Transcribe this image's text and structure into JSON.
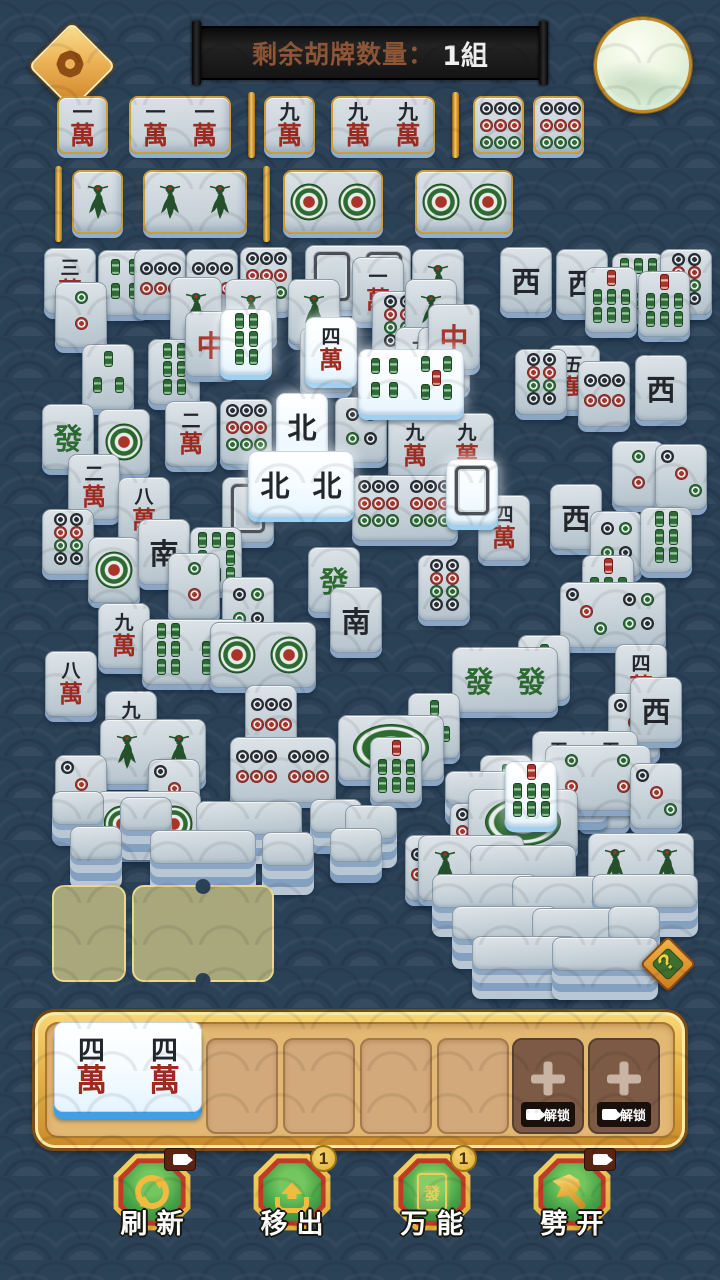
{
  "header": {
    "banner_label": "剩余胡牌数量：",
    "banner_value": "1組",
    "settings_icon": "gear-icon",
    "moon_decoration": "moon"
  },
  "help": {
    "label": "?"
  },
  "colors": {
    "background": "#2b4156",
    "gold": "#e8b83c",
    "tile_body": "#c6d1d8",
    "tile_highlight": "#ffffff",
    "tile_rim": "#8ba6c5",
    "tile_rim_highlight": "#9ed0f2",
    "face_red": "#9e2b22",
    "face_green": "#2d6b33",
    "face_black": "#23272b"
  },
  "legend": {
    "w": "characters tile: number over 萬",
    "d": "dots tile (number of circles)",
    "b": "bamboo tile (number of sticks, b1 is the bird)",
    "back": "face-down tile",
    "edge": "stacked tile edge, no face visible",
    "wan_nums": [
      "一",
      "二",
      "三",
      "四",
      "五",
      "六",
      "七",
      "八",
      "九"
    ],
    "wan_char": "萬",
    "honors": {
      "C": "中",
      "F": "發",
      "N": "北",
      "S": "南",
      "W": "西"
    }
  },
  "collection": {
    "row1": [
      {
        "kind": "tile",
        "x": 57,
        "y": 96,
        "w": 51,
        "h": 58,
        "f": [
          "w1"
        ]
      },
      {
        "kind": "tile",
        "x": 129,
        "y": 96,
        "w": 102,
        "h": 58,
        "f": [
          "w1",
          "w1"
        ]
      },
      {
        "kind": "sep",
        "x": 248,
        "y": 92,
        "h": 66
      },
      {
        "kind": "tile",
        "x": 264,
        "y": 96,
        "w": 51,
        "h": 58,
        "f": [
          "w9"
        ]
      },
      {
        "kind": "tile",
        "x": 331,
        "y": 96,
        "w": 104,
        "h": 58,
        "f": [
          "w9",
          "w9"
        ]
      },
      {
        "kind": "sep",
        "x": 452,
        "y": 92,
        "h": 66
      },
      {
        "kind": "tile",
        "x": 473,
        "y": 96,
        "w": 51,
        "h": 58,
        "f": [
          "d9"
        ]
      },
      {
        "kind": "tile",
        "x": 533,
        "y": 96,
        "w": 51,
        "h": 58,
        "f": [
          "d9"
        ]
      }
    ],
    "row2": [
      {
        "kind": "sep",
        "x": 55,
        "y": 166,
        "h": 76
      },
      {
        "kind": "tile",
        "x": 72,
        "y": 170,
        "w": 51,
        "h": 64,
        "f": [
          "b1"
        ]
      },
      {
        "kind": "tile",
        "x": 143,
        "y": 170,
        "w": 104,
        "h": 64,
        "f": [
          "b1",
          "b1"
        ]
      },
      {
        "kind": "sep",
        "x": 263,
        "y": 166,
        "h": 76
      },
      {
        "kind": "tile",
        "x": 283,
        "y": 170,
        "w": 100,
        "h": 64,
        "f": [
          "d1",
          "d1"
        ]
      },
      {
        "kind": "tile",
        "x": 415,
        "y": 170,
        "w": 98,
        "h": 64,
        "f": [
          "d1",
          "d1"
        ]
      }
    ]
  },
  "pile": [
    {
      "x": 44,
      "y": 248,
      "f": [
        "w3"
      ]
    },
    {
      "x": 98,
      "y": 250,
      "f": [
        "b4"
      ]
    },
    {
      "x": 134,
      "y": 249,
      "f": [
        "d6"
      ]
    },
    {
      "x": 186,
      "y": 249,
      "f": [
        "d6"
      ]
    },
    {
      "x": 240,
      "y": 247,
      "f": [
        "d9"
      ]
    },
    {
      "x": 305,
      "y": 245,
      "w": 106,
      "f": [
        "back",
        "back"
      ]
    },
    {
      "x": 352,
      "y": 257,
      "f": [
        "w1"
      ]
    },
    {
      "x": 412,
      "y": 249,
      "f": [
        "b1"
      ]
    },
    {
      "x": 500,
      "y": 247,
      "f": [
        "W"
      ]
    },
    {
      "x": 556,
      "y": 249,
      "f": [
        "W"
      ]
    },
    {
      "x": 612,
      "y": 253,
      "f": [
        "b8"
      ]
    },
    {
      "x": 660,
      "y": 249,
      "f": [
        "d8"
      ]
    },
    {
      "x": 55,
      "y": 282,
      "f": [
        "d2"
      ]
    },
    {
      "x": 170,
      "y": 277,
      "f": [
        "b1"
      ]
    },
    {
      "x": 225,
      "y": 279,
      "f": [
        "b1"
      ]
    },
    {
      "x": 288,
      "y": 279,
      "f": [
        "b1"
      ]
    },
    {
      "x": 372,
      "y": 291,
      "f": [
        "d8"
      ]
    },
    {
      "x": 405,
      "y": 279,
      "f": [
        "b1"
      ]
    },
    {
      "x": 585,
      "y": 267,
      "f": [
        "b7"
      ]
    },
    {
      "x": 638,
      "y": 271,
      "f": [
        "b7"
      ]
    },
    {
      "x": 82,
      "y": 344,
      "f": [
        "b3"
      ]
    },
    {
      "x": 148,
      "y": 339,
      "f": [
        "b6"
      ]
    },
    {
      "x": 185,
      "y": 311,
      "f": [
        "C"
      ]
    },
    {
      "x": 300,
      "y": 327,
      "f": [
        "w2"
      ]
    },
    {
      "x": 395,
      "y": 327,
      "f": [
        "w9"
      ]
    },
    {
      "x": 418,
      "y": 327,
      "f": [
        "w2"
      ]
    },
    {
      "x": 428,
      "y": 304,
      "f": [
        "C"
      ]
    },
    {
      "x": 548,
      "y": 345,
      "f": [
        "w5"
      ]
    },
    {
      "x": 578,
      "y": 361,
      "f": [
        "d6"
      ]
    },
    {
      "x": 635,
      "y": 355,
      "f": [
        "W"
      ]
    },
    {
      "x": 42,
      "y": 404,
      "f": [
        "F"
      ]
    },
    {
      "x": 98,
      "y": 409,
      "f": [
        "d1"
      ]
    },
    {
      "x": 165,
      "y": 401,
      "f": [
        "w2"
      ]
    },
    {
      "x": 220,
      "y": 399,
      "f": [
        "d9"
      ]
    },
    {
      "x": 335,
      "y": 397,
      "f": [
        "d4"
      ]
    },
    {
      "x": 515,
      "y": 349,
      "f": [
        "d8"
      ]
    },
    {
      "x": 388,
      "y": 413,
      "w": 106,
      "f": [
        "w9",
        "w9"
      ]
    },
    {
      "x": 612,
      "y": 441,
      "f": [
        "d2"
      ]
    },
    {
      "x": 655,
      "y": 444,
      "f": [
        "d3"
      ]
    },
    {
      "x": 68,
      "y": 454,
      "f": [
        "w2"
      ]
    },
    {
      "x": 118,
      "y": 477,
      "f": [
        "w8"
      ]
    },
    {
      "x": 42,
      "y": 509,
      "f": [
        "d8"
      ]
    },
    {
      "x": 222,
      "y": 477,
      "f": [
        "back"
      ]
    },
    {
      "x": 352,
      "y": 475,
      "w": 106,
      "f": [
        "d9",
        "d9"
      ]
    },
    {
      "x": 478,
      "y": 495,
      "f": [
        "w4"
      ]
    },
    {
      "x": 550,
      "y": 484,
      "f": [
        "W"
      ]
    },
    {
      "x": 590,
      "y": 511,
      "f": [
        "d4"
      ]
    },
    {
      "x": 640,
      "y": 507,
      "f": [
        "b6"
      ]
    },
    {
      "x": 88,
      "y": 537,
      "f": [
        "d1"
      ]
    },
    {
      "x": 138,
      "y": 519,
      "f": [
        "S"
      ]
    },
    {
      "x": 190,
      "y": 527,
      "f": [
        "b8"
      ]
    },
    {
      "x": 308,
      "y": 547,
      "f": [
        "F"
      ]
    },
    {
      "x": 418,
      "y": 555,
      "f": [
        "d8"
      ]
    },
    {
      "x": 582,
      "y": 555,
      "f": [
        "b7"
      ]
    },
    {
      "x": 168,
      "y": 553,
      "f": [
        "d2"
      ]
    },
    {
      "x": 222,
      "y": 577,
      "f": [
        "d4"
      ]
    },
    {
      "x": 98,
      "y": 603,
      "f": [
        "w9"
      ]
    },
    {
      "x": 330,
      "y": 587,
      "f": [
        "S"
      ]
    },
    {
      "x": 560,
      "y": 582,
      "w": 106,
      "f": [
        "d3",
        "d4"
      ]
    },
    {
      "x": 142,
      "y": 619,
      "w": 106,
      "f": [
        "b6",
        "b7"
      ]
    },
    {
      "x": 210,
      "y": 622,
      "w": 106,
      "f": [
        "d1",
        "d1"
      ]
    },
    {
      "x": 518,
      "y": 635,
      "f": [
        "b2"
      ]
    },
    {
      "x": 615,
      "y": 644,
      "f": [
        "w4"
      ]
    },
    {
      "x": 452,
      "y": 647,
      "w": 106,
      "f": [
        "F",
        "F"
      ]
    },
    {
      "x": 45,
      "y": 651,
      "f": [
        "w8"
      ]
    },
    {
      "x": 245,
      "y": 685,
      "f": [
        "d6"
      ]
    },
    {
      "x": 408,
      "y": 693,
      "f": [
        "b3"
      ]
    },
    {
      "x": 608,
      "y": 693,
      "f": [
        "d3"
      ]
    },
    {
      "x": 630,
      "y": 677,
      "f": [
        "W"
      ]
    },
    {
      "x": 105,
      "y": 691,
      "f": [
        "w9"
      ]
    },
    {
      "x": 338,
      "y": 715,
      "w": 106,
      "f": [
        "d1w"
      ]
    },
    {
      "x": 100,
      "y": 719,
      "w": 106,
      "f": [
        "b1",
        "b1"
      ]
    },
    {
      "x": 532,
      "y": 731,
      "w": 106,
      "f": [
        "w5",
        "w5"
      ]
    },
    {
      "x": 230,
      "y": 737,
      "w": 106,
      "f": [
        "d6",
        "d6"
      ]
    },
    {
      "x": 370,
      "y": 737,
      "f": [
        "b7"
      ]
    },
    {
      "x": 55,
      "y": 755,
      "f": [
        "d3"
      ]
    },
    {
      "x": 148,
      "y": 759,
      "f": [
        "d3"
      ]
    },
    {
      "x": 480,
      "y": 755,
      "f": [
        "b2"
      ]
    },
    {
      "x": 578,
      "y": 763,
      "f": [
        "d4"
      ]
    },
    {
      "x": 95,
      "y": 791,
      "w": 106,
      "f": [
        "d1",
        "d1"
      ]
    },
    {
      "x": 405,
      "y": 835,
      "f": [
        "d6"
      ]
    },
    {
      "x": 482,
      "y": 814,
      "f": [
        "d2"
      ]
    },
    {
      "x": 445,
      "y": 771,
      "w": 106,
      "f": [
        "edge"
      ],
      "st": 2
    },
    {
      "x": 556,
      "y": 775,
      "f": [
        "edge"
      ],
      "st": 2
    },
    {
      "x": 52,
      "y": 791,
      "f": [
        "edge"
      ],
      "st": 2
    },
    {
      "x": 120,
      "y": 797,
      "f": [
        "edge"
      ],
      "st": 3
    },
    {
      "x": 196,
      "y": 801,
      "w": 106,
      "f": [
        "edge"
      ],
      "st": 3
    },
    {
      "x": 310,
      "y": 799,
      "f": [
        "edge"
      ],
      "st": 2
    },
    {
      "x": 345,
      "y": 805,
      "f": [
        "edge"
      ],
      "st": 3
    },
    {
      "x": 70,
      "y": 826,
      "f": [
        "edge"
      ],
      "st": 3
    },
    {
      "x": 150,
      "y": 830,
      "w": 106,
      "f": [
        "edge"
      ],
      "st": 3
    },
    {
      "x": 262,
      "y": 832,
      "f": [
        "edge"
      ],
      "st": 3
    },
    {
      "x": 330,
      "y": 828,
      "f": [
        "edge"
      ],
      "st": 2
    }
  ],
  "side_pile": [
    {
      "x": 545,
      "y": 745,
      "w": 106,
      "f": [
        "d2",
        "d2"
      ]
    },
    {
      "x": 630,
      "y": 763,
      "f": [
        "d3"
      ]
    },
    {
      "x": 450,
      "y": 803,
      "f": [
        "d9"
      ]
    },
    {
      "x": 468,
      "y": 789,
      "w": 110,
      "f": [
        "d1w"
      ]
    },
    {
      "x": 418,
      "y": 835,
      "w": 106,
      "f": [
        "b1",
        "b1"
      ]
    },
    {
      "x": 588,
      "y": 833,
      "w": 106,
      "f": [
        "b1",
        "b1"
      ]
    },
    {
      "x": 470,
      "y": 845,
      "w": 106,
      "f": [
        "edge"
      ],
      "st": 2
    },
    {
      "x": 432,
      "y": 874,
      "w": 106,
      "f": [
        "edge"
      ],
      "st": 3
    },
    {
      "x": 512,
      "y": 876,
      "w": 106,
      "f": [
        "edge"
      ],
      "st": 3
    },
    {
      "x": 592,
      "y": 874,
      "w": 106,
      "f": [
        "edge"
      ],
      "st": 3
    },
    {
      "x": 452,
      "y": 906,
      "w": 106,
      "f": [
        "edge"
      ],
      "st": 3
    },
    {
      "x": 532,
      "y": 908,
      "w": 106,
      "f": [
        "edge"
      ],
      "st": 3
    },
    {
      "x": 608,
      "y": 906,
      "f": [
        "edge"
      ],
      "st": 3
    },
    {
      "x": 472,
      "y": 936,
      "w": 106,
      "f": [
        "edge"
      ],
      "st": 3
    },
    {
      "x": 552,
      "y": 937,
      "w": 106,
      "f": [
        "edge"
      ],
      "st": 3
    }
  ],
  "highlighted_tiles": [
    {
      "x": 220,
      "y": 309,
      "f": [
        "b6"
      ],
      "hl": 1
    },
    {
      "x": 305,
      "y": 317,
      "f": [
        "w4"
      ],
      "hl": 1
    },
    {
      "x": 358,
      "y": 349,
      "w": 106,
      "f": [
        "b4",
        "b5"
      ],
      "hl": 1
    },
    {
      "x": 276,
      "y": 393,
      "f": [
        "N"
      ],
      "hl": 1
    },
    {
      "x": 248,
      "y": 451,
      "w": 106,
      "f": [
        "N",
        "N"
      ],
      "hl": 1
    },
    {
      "x": 446,
      "y": 459,
      "f": [
        "back"
      ],
      "hl": 1
    },
    {
      "x": 505,
      "y": 761,
      "f": [
        "b7"
      ],
      "hl": 1
    }
  ],
  "empty_slots": {
    "single": {
      "x": 52,
      "y": 885,
      "w": 74,
      "h": 97
    },
    "double": {
      "x": 132,
      "y": 885,
      "w": 142,
      "h": 97
    }
  },
  "tray": {
    "held_tile": {
      "x": 54,
      "y": 1022,
      "w": 148,
      "h": 90,
      "f": [
        "w4",
        "w4"
      ],
      "hl": 1
    },
    "empty_slot_xs": [
      206,
      283,
      360,
      437
    ],
    "locked_slot_xs": [
      512,
      588
    ],
    "locked_label": "解锁"
  },
  "buttons": [
    {
      "label": "刷新",
      "icon": "refresh-icon",
      "badge": {
        "type": "video"
      }
    },
    {
      "label": "移出",
      "icon": "move-out-icon",
      "badge": {
        "type": "count",
        "value": "1"
      }
    },
    {
      "label": "万能",
      "icon": "wildcard-tile-icon",
      "icon_char": "發",
      "badge": {
        "type": "count",
        "value": "1"
      }
    },
    {
      "label": "劈开",
      "icon": "axe-icon",
      "badge": {
        "type": "video"
      }
    }
  ]
}
